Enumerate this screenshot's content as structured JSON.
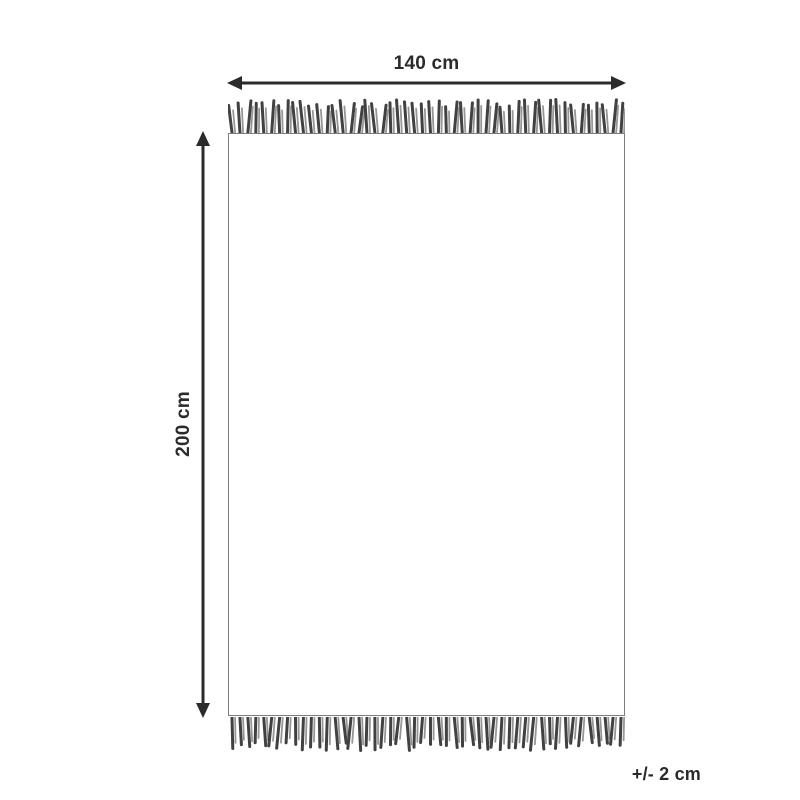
{
  "diagram": {
    "width_label": "140 cm",
    "height_label": "200 cm",
    "tolerance_label": "+/- 2 cm"
  },
  "colors": {
    "line": "#2b2b2b",
    "outline": "#7e7e7e",
    "background": "#ffffff",
    "fringe_dark": "#414141",
    "fringe_light": "#969696"
  },
  "fringe": {
    "strand_count": 50
  }
}
